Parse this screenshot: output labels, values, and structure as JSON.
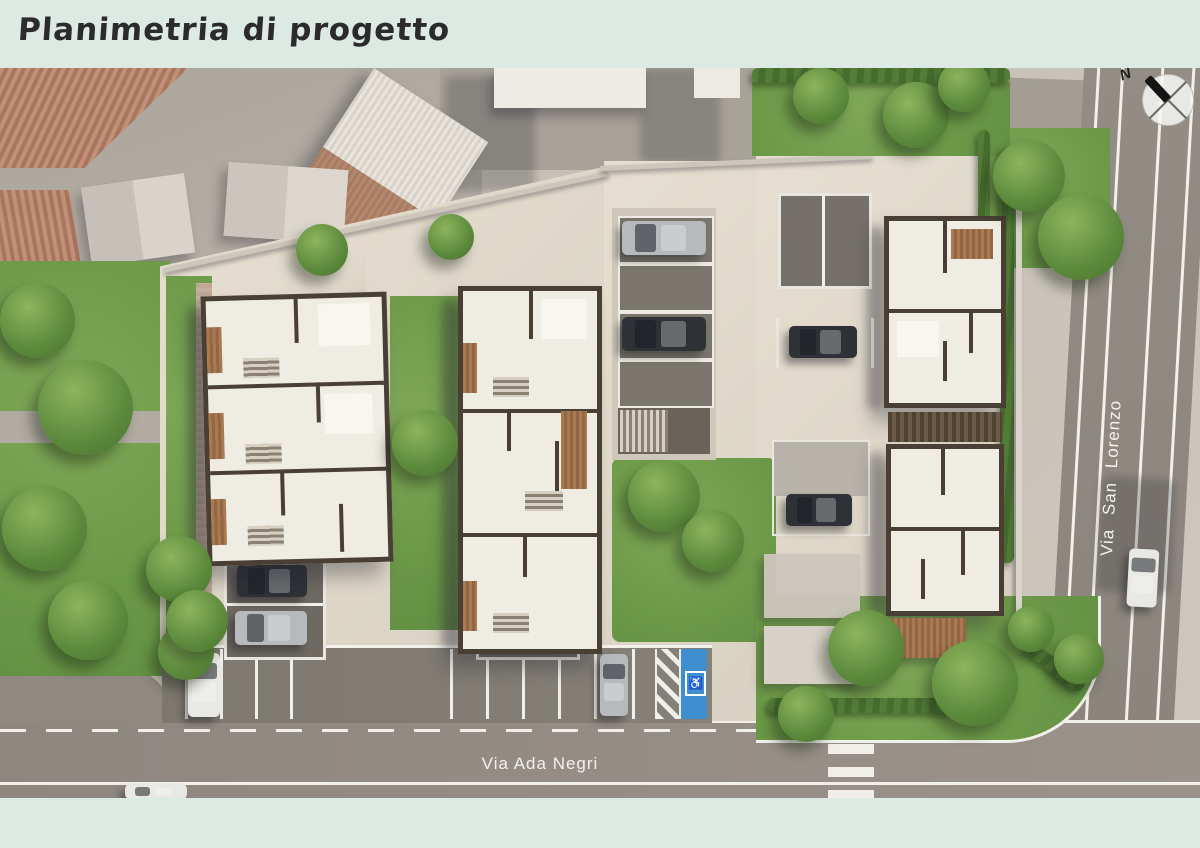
{
  "page": {
    "title": "Planimetria di progetto",
    "background_color": "#dde9e3",
    "title_color": "#2b2b2b"
  },
  "plan": {
    "description": "Aerial 3D rendering of the residential project site plan",
    "streets": [
      {
        "name": "Via Ada Negri",
        "orientation": "horizontal-bottom"
      },
      {
        "name": "Via San Lorenzo",
        "orientation": "vertical-right"
      }
    ],
    "compass": {
      "label": "N",
      "needle": "points north-west"
    },
    "parking": {
      "accessible_symbol": "♿",
      "central_stalls": 4,
      "street_stalls": 10,
      "accessible_stalls": 1,
      "parked_cars": 12
    },
    "buildings": {
      "new_townhouse_rows": 3,
      "context": "existing houses with tiled roofs to the north-west"
    },
    "colors": {
      "grass": "#6f9c4a",
      "paving_cream": "#ddd6c8",
      "asphalt": "#8f8982",
      "building_walls": "#4a3f34",
      "building_roof": "#efece3",
      "accessible_blue": "#3f8ed0",
      "tile_roof": "#bb8a74",
      "wood_deck": "#a87a52"
    }
  }
}
